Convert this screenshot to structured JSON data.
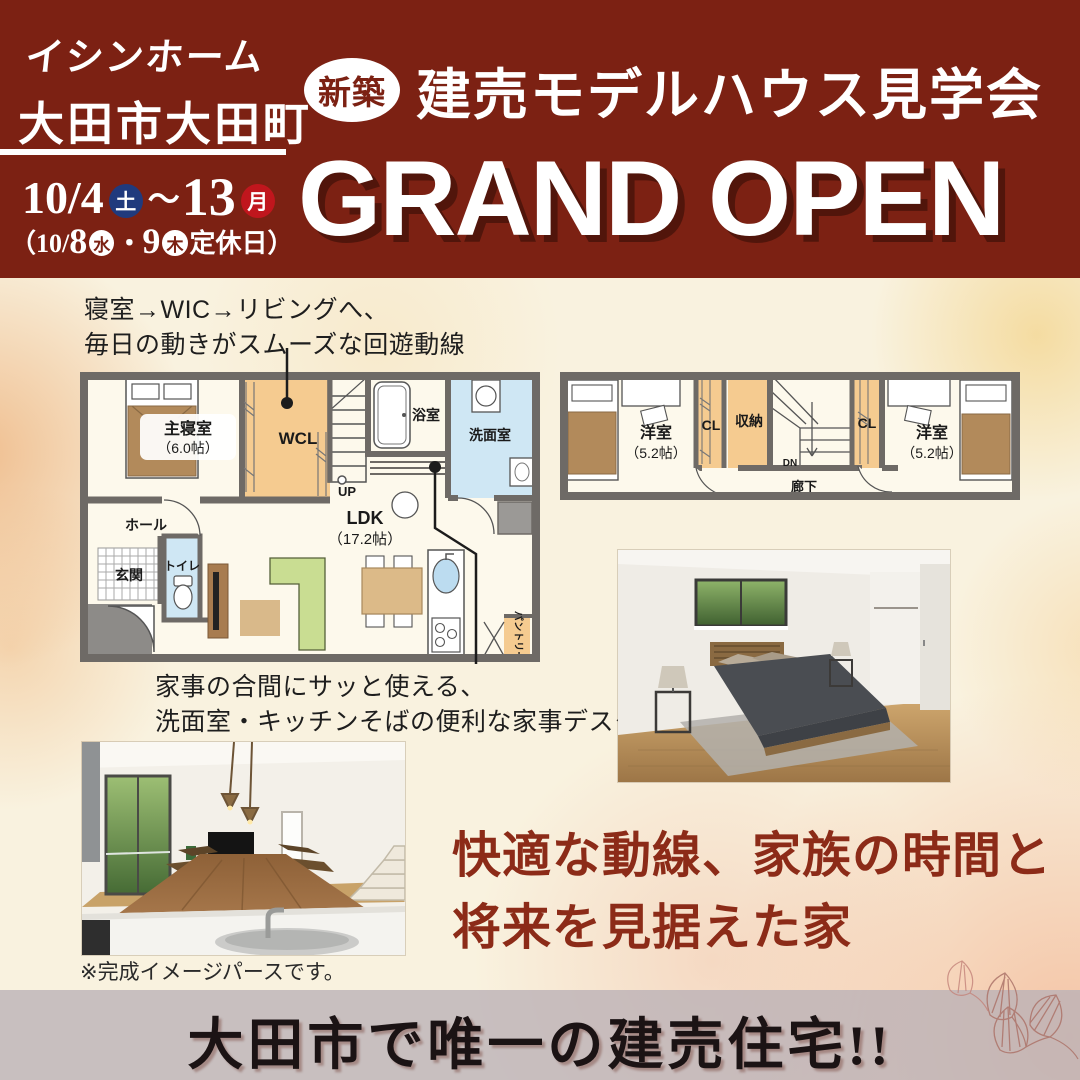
{
  "colors": {
    "header_bg": "#7c2113",
    "accent_blue": "#203a7d",
    "accent_red": "#c0161d",
    "catch_text": "#8c2b18",
    "storage_orange": "#f5cb90",
    "water_blue": "#cfe7f4",
    "wall_gray": "#6e6a66"
  },
  "header": {
    "logo": "イシンホーム",
    "location": "大田市大田町",
    "date_main": {
      "start": "10/4",
      "start_day": "土",
      "tilde": "〜",
      "end": "13",
      "end_day": "月"
    },
    "date_note": {
      "p1": "（10/",
      "d1": "8",
      "day1": "水",
      "dot": "・",
      "d2": "9",
      "day2": "木",
      "p2": "定休日）"
    },
    "badge": "新築",
    "title": "建売モデルハウス見学会",
    "grand_open": "GRAND OPEN"
  },
  "annotations": {
    "flow_line1": "寝室→WIC→リビングへ、",
    "flow_line2": "毎日の動きがスムーズな回遊動線",
    "desk_line1": "家事の合間にサッと使える、",
    "desk_line2": "洗面室・キッチンそばの便利な家事デスク"
  },
  "plan1": {
    "bedroom": "主寝室",
    "bedroom_size": "（6.0帖）",
    "wcl": "WCL",
    "bath": "浴室",
    "washroom": "洗面室",
    "hall": "ホール",
    "entrance": "玄関",
    "toilet": "トイレ",
    "up": "UP",
    "ldk": "LDK",
    "ldk_size": "（17.2帖）",
    "pantry": "パントリー"
  },
  "plan2": {
    "room_left": "洋室",
    "room_left_size": "（5.2帖）",
    "cl_left": "CL",
    "storage": "収納",
    "dn": "DN",
    "hallway": "廊下",
    "cl_right": "CL",
    "room_right": "洋室",
    "room_right_size": "（5.2帖）"
  },
  "caption": "※完成イメージパースです。",
  "catchcopy": {
    "line1": "快適な動線、家族の時間と",
    "line2": "将来を見据えた家"
  },
  "footer": {
    "text": "大田市で唯一の建売住宅!!"
  }
}
